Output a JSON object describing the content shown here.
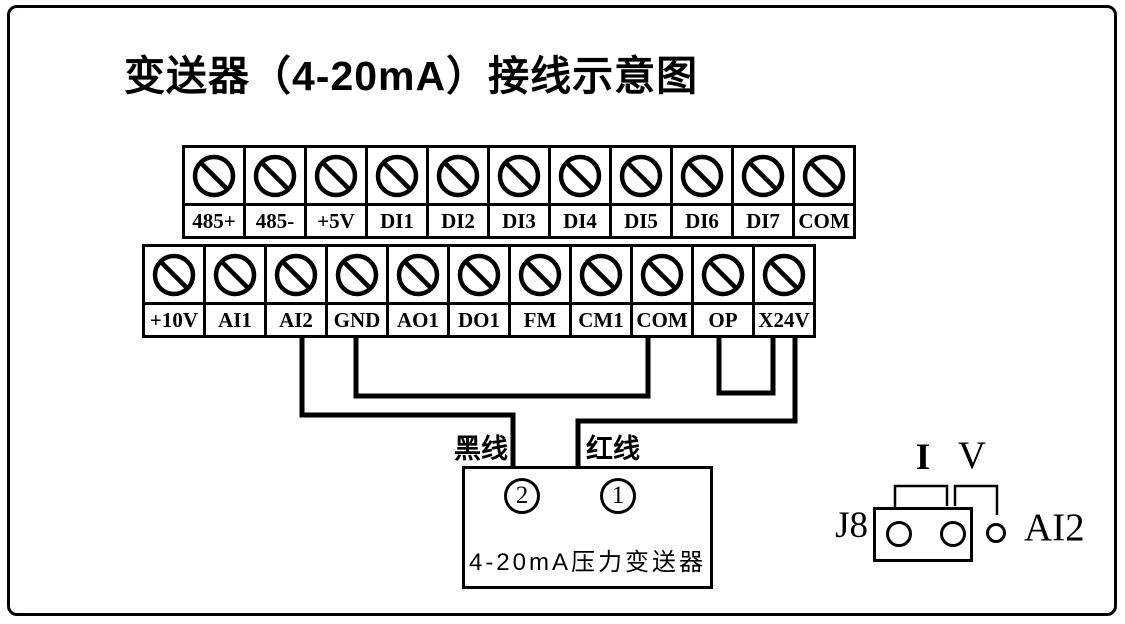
{
  "diagram": {
    "title": "变送器（4-20mA）接线示意图"
  },
  "terminal_block": {
    "top_row": [
      "485+",
      "485-",
      "+5V",
      "DI1",
      "DI2",
      "DI3",
      "DI4",
      "DI5",
      "DI6",
      "DI7",
      "COM"
    ],
    "bottom_row": [
      "+10V",
      "AI1",
      "AI2",
      "GND",
      "AO1",
      "DO1",
      "FM",
      "CM1",
      "COM",
      "OP",
      "X24V"
    ]
  },
  "wires": {
    "black_wire_label": "黑线",
    "red_wire_label": "红线",
    "connections": [
      {
        "from": "AI2",
        "to": "变送器 ②",
        "wire": "黑线"
      },
      {
        "from": "GND",
        "to": "COM"
      },
      {
        "from": "OP",
        "to": "X24V"
      },
      {
        "from": "X24V",
        "to": "变送器 ①",
        "wire": "红线"
      }
    ]
  },
  "transmitter": {
    "terminal_2": "2",
    "terminal_1": "1",
    "label": "4-20mA压力变送器"
  },
  "jumper": {
    "name": "J8",
    "channel": "AI2",
    "current_mode_label": "I",
    "voltage_mode_label": "V"
  },
  "colors": {
    "ink": "#000000",
    "background": "#ffffff"
  }
}
